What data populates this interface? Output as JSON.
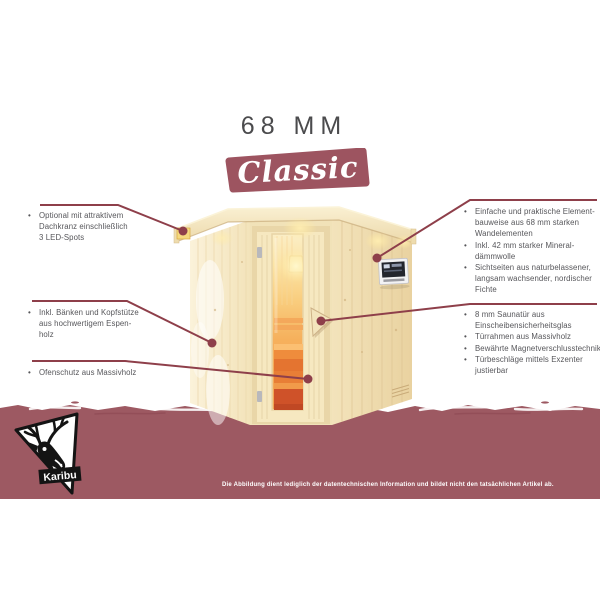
{
  "header": {
    "thickness_label": "68 MM",
    "series_name": "Classic"
  },
  "bullet_glyph": "•",
  "features_left": [
    {
      "id": "bl1",
      "items": [
        {
          "lines": [
            "Optional mit attraktivem",
            "Dachkranz einschließlich",
            "3 LED-Spots"
          ]
        }
      ]
    },
    {
      "id": "bl2",
      "items": [
        {
          "lines": [
            "Inkl. Bänken und Kopfstütze",
            "aus hochwertigem Espen-",
            "holz"
          ]
        }
      ]
    },
    {
      "id": "bl3",
      "items": [
        {
          "lines": [
            "Ofenschutz aus Massivholz"
          ]
        }
      ]
    }
  ],
  "features_right": [
    {
      "id": "br1",
      "items": [
        {
          "lines": [
            "Einfache und praktische Element-",
            "bauweise aus 68 mm starken",
            "Wandelementen"
          ]
        },
        {
          "lines": [
            "Inkl. 42 mm starker Mineral-",
            "dämmwolle"
          ]
        },
        {
          "lines": [
            "Sichtseiten aus naturbelassener,",
            "langsam wachsender, nordischer",
            "Fichte"
          ]
        }
      ]
    },
    {
      "id": "br2",
      "items": [
        {
          "lines": [
            "8 mm Saunatür aus",
            "Einscheibensicherheitsglas"
          ]
        },
        {
          "lines": [
            "Türrahmen aus Massivholz"
          ]
        },
        {
          "lines": [
            "Bewährte Magnetverschlusstechnik"
          ]
        },
        {
          "lines": [
            "Türbeschläge mittels Exzenter",
            "justierbar"
          ]
        }
      ]
    }
  ],
  "footer": {
    "brand": "Karibu",
    "disclaimer": "Die Abbildung dient lediglich der datentechnischen Information und bildet nicht den tatsächlichen Artikel ab."
  },
  "illustration": {
    "subject": "corner-element-sauna",
    "parts": [
      "roof-crown",
      "led-spot",
      "wood-wall",
      "sauna-door",
      "door-glass",
      "door-handle",
      "control-panel",
      "door-hinge",
      "vent-grille"
    ]
  },
  "colors": {
    "band_maroon": "#9d5962",
    "banner_maroon": "#9d5460",
    "callout_line": "#8e3f4a",
    "body_text": "#56565a",
    "heading_text": "#4b4b4d",
    "disclaimer_text": "#ffffff",
    "wood_light": "#f8ecca",
    "wood_mid": "#f0dfb4",
    "glass_glow": "#f6b05c"
  }
}
